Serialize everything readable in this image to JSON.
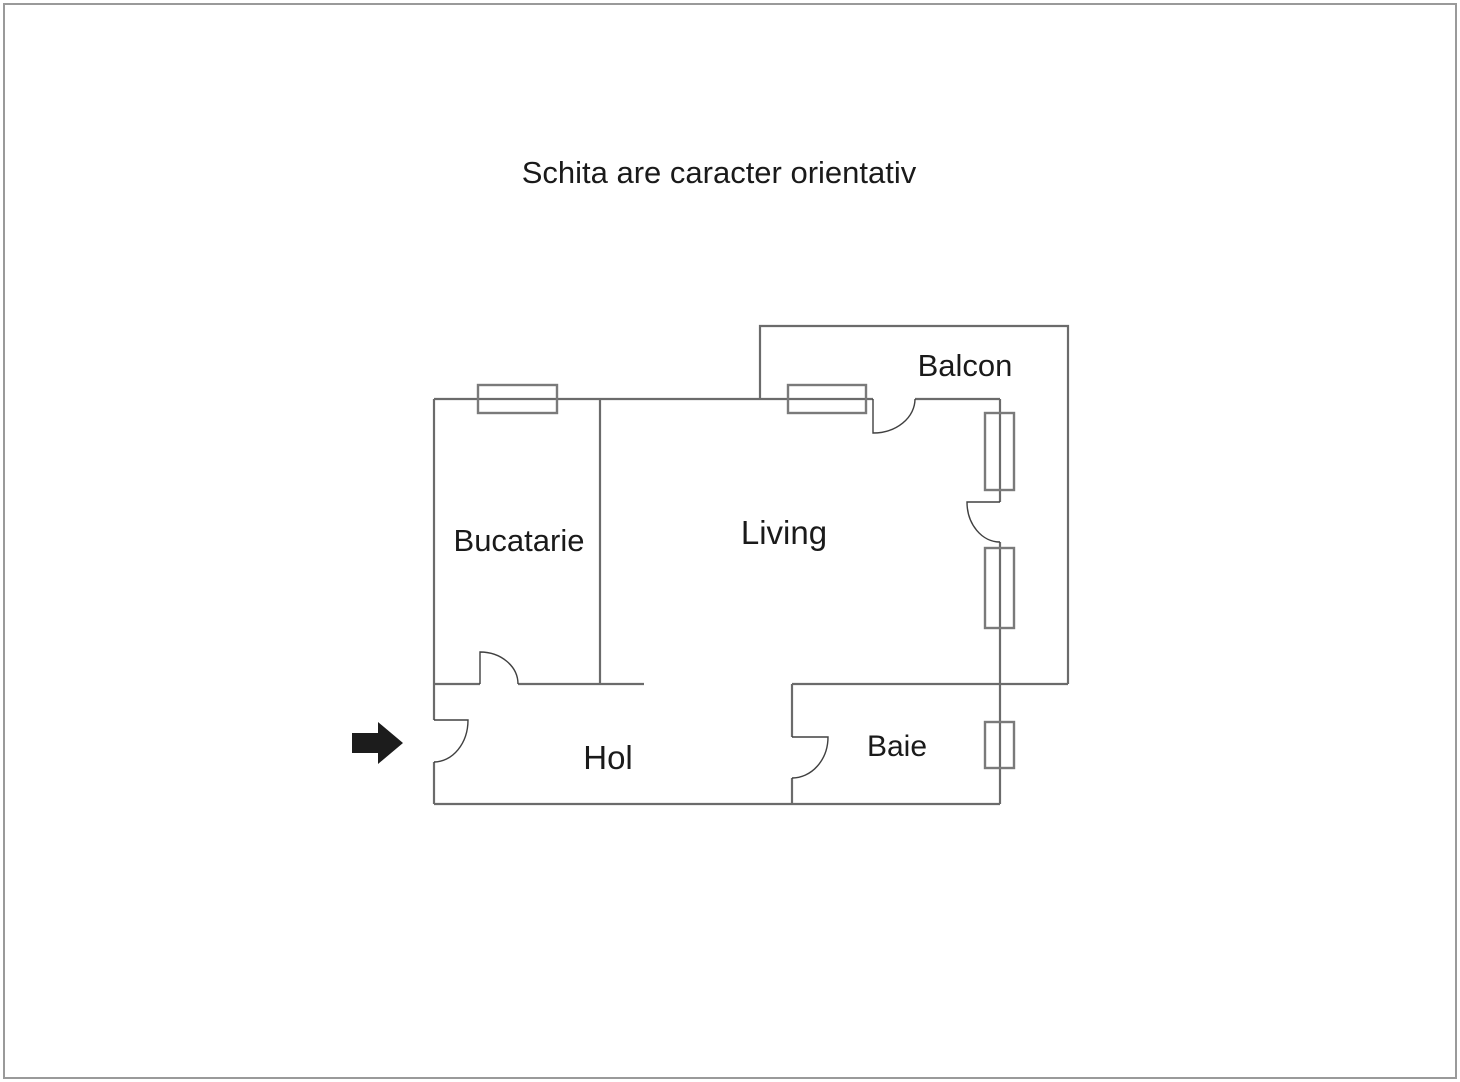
{
  "title": "Schita are caracter orientativ",
  "colors": {
    "wall": "#6b6b6b",
    "window": "#7a7a7a",
    "door": "#404040",
    "text": "#1a1a1a",
    "border": "#9a9a9a",
    "arrow": "#1c1c1c"
  },
  "rooms": [
    {
      "id": "bucatarie",
      "label": "Bucatarie"
    },
    {
      "id": "living",
      "label": "Living"
    },
    {
      "id": "balcon",
      "label": "Balcon"
    },
    {
      "id": "hol",
      "label": "Hol"
    },
    {
      "id": "baie",
      "label": "Baie"
    }
  ]
}
